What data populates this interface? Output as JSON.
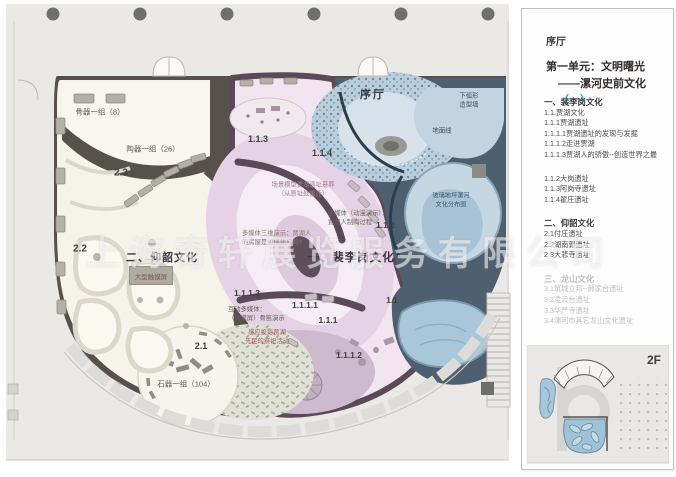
{
  "watermark": "上海奇轩展览服务有限公司",
  "colors": {
    "accent_blue": "#29a3dc",
    "highlight_blue": "#9fc2d8",
    "wall_dark": "#57504b",
    "wall_purple": "#5a4a58"
  },
  "plan": {
    "areas": {
      "lobby": "序厅",
      "unit1": "一、裴李岗文化",
      "unit2": "二、仰韶文化"
    },
    "labels": {
      "bone_group": "骨器一组（8）",
      "pottery_group": "陶器一组（26）",
      "stone_group": "石器一组（104）",
      "touchscreen": "大型触摸屏",
      "scene_model_l1": "场景模型贾湖遗址墓葬",
      "scene_model_l2": "（从原址处搬迁）",
      "mm_anim_l1": "多媒体（动漫演示）：",
      "mm_anim_l2": "贾湖人制陶过程",
      "mm_3d_l1": "多媒体三维演示：贾湖人",
      "mm_3d_l2": "的房屋是如何建成的?",
      "interactive_l1": "互动多媒体：",
      "interactive_l2": "（触摸屏）骨笛演示",
      "projection_l1": "感应投影贾湖",
      "projection_l2": "先民的祭祀活动",
      "arc_wall_l1": "下弧形",
      "arc_wall_l2": "造型墙",
      "ground_line": "地面线",
      "glass_l1": "玻璃地坪漯河",
      "glass_l2": "文化分布图"
    },
    "codes": {
      "c11": "1.1",
      "c111": "1.1.1",
      "c112": "1.1.2",
      "c113": "1.1.3",
      "c114": "1.1.4",
      "c1111": "1.1.1.1",
      "c1112": "1.1.1.2",
      "c1113": "1.1.1.3",
      "c21": "2.1",
      "c22": "2.2",
      "c23": "2.3"
    }
  },
  "sidebar": {
    "lobby": "序厅",
    "unit_title": "第一单元：文明曙光",
    "unit_subtitle": "——漯河史前文化",
    "unit_subtitle_num": "（一）",
    "outline": [
      "一、裴李岗文化",
      "1.1.贾湖文化",
      "1.1.1贾湖遗址",
      "1.1.1.1贾湖遗址的发现与发掘",
      "1.1.1.2走进贾湖",
      "1.1.1.3贾湖人的骄傲--创造世界之最",
      "1.1.2大岗遗址",
      "1.1.3阿岗寺遗址",
      "1.1.4翟庄遗址",
      "二、仰韶文化",
      "2.1付庄遗址",
      "2.2湖南郭遗址",
      "2.3大悲寺遗址",
      "三、龙山文化",
      "3.1筑城立邦--郝家台遗址",
      "3.2凌云台遗址",
      "3.3华严寺遗址",
      "3.4漯河市其它龙山文化遗址"
    ],
    "floor_tag": "2F"
  }
}
